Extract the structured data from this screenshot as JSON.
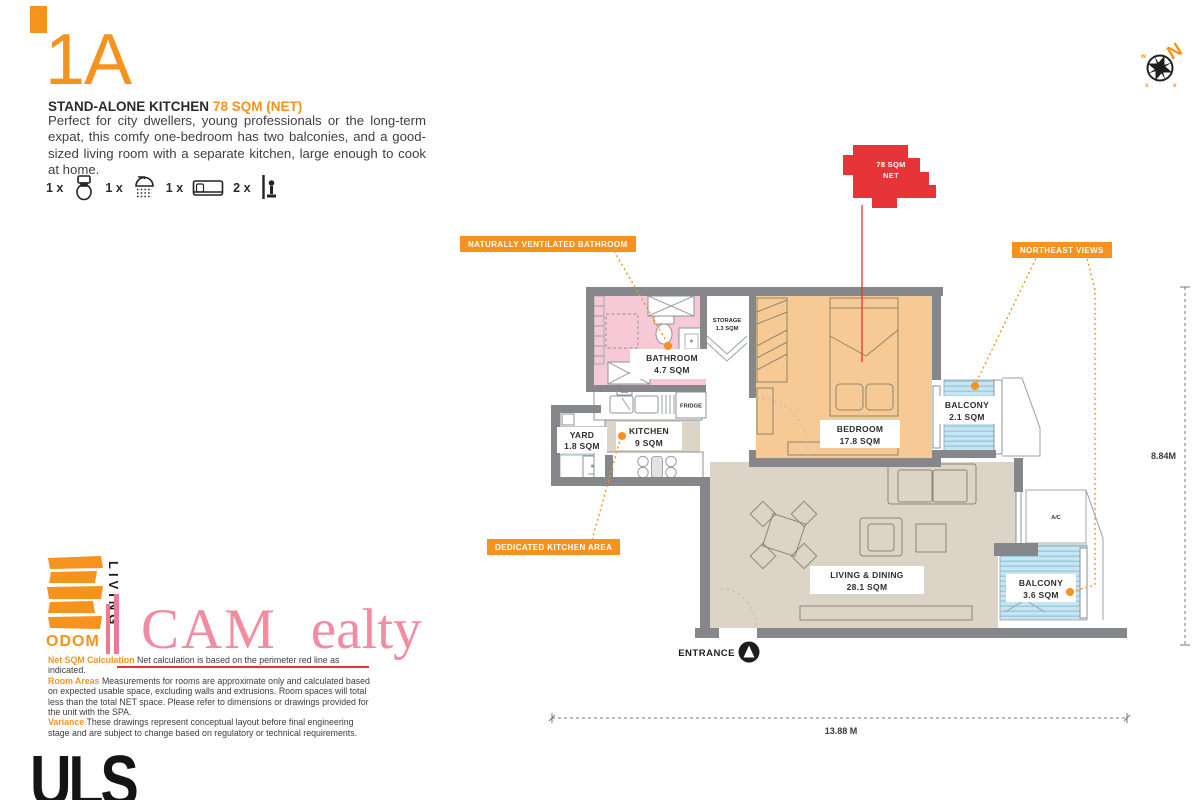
{
  "header": {
    "unit": "1A",
    "subtitle": "STAND-ALONE KITCHEN",
    "area_label": "78 SQM (NET)",
    "description": "Perfect for city dwellers, young professionals or the long-term expat, this comfy one-bedroom has two balconies, and a good-sized living room with a separate kitchen, large enough to cook at home.",
    "features": [
      {
        "qty": "1 x",
        "icon": "toilet-icon"
      },
      {
        "qty": "1 x",
        "icon": "shower-icon"
      },
      {
        "qty": "1 x",
        "icon": "bed-icon"
      },
      {
        "qty": "2 x",
        "icon": "balcony-icon"
      }
    ]
  },
  "compass": {
    "north": "N",
    "west": "w",
    "south": "s",
    "east": "e"
  },
  "plan": {
    "tag": {
      "line1": "78 SQM",
      "line2": "NET"
    },
    "callouts": {
      "bathroom": "NATURALLY VENTILATED BATHROOM",
      "northeast": "NORTHEAST VIEWS",
      "kitchen": "DEDICATED KITCHEN AREA"
    },
    "rooms": {
      "bathroom": {
        "name": "BATHROOM",
        "area": "4.7 SQM"
      },
      "storage": {
        "name": "STORAGE",
        "area": "1.3 SQM"
      },
      "kitchen": {
        "name": "KITCHEN",
        "area": "9 SQM"
      },
      "yard": {
        "name": "YARD",
        "area": "1.8 SQM"
      },
      "bedroom": {
        "name": "BEDROOM",
        "area": "17.8 SQM"
      },
      "balcony1": {
        "name": "BALCONY",
        "area": "2.1 SQM"
      },
      "living": {
        "name": "LIVING & DINING",
        "area": "28.1 SQM"
      },
      "balcony2": {
        "name": "BALCONY",
        "area": "3.6 SQM"
      }
    },
    "fixtures": {
      "fridge": "FRIDGE",
      "ac": "A/C",
      "sink": "S/B"
    },
    "entrance": "ENTRANCE",
    "dimensions": {
      "width": "13.88 M",
      "height": "8.84M"
    }
  },
  "footer": {
    "legal": [
      {
        "label": "Net SQM Calculation",
        "text": " Net calculation is based on the perimeter red line as indicated."
      },
      {
        "label": "Room Areas",
        "text": " Measurements for rooms are approximate only and calculated based on expected usable space, excluding walls and extrusions. Room spaces will total less than the total NET space. Please refer to dimensions or drawings provided for the unit with the SPA."
      },
      {
        "label": "Variance",
        "text": " These drawings represent conceptual layout before final engineering stage and are subject to change based on regulatory or technical requirements."
      }
    ]
  },
  "logos": {
    "odom": "ODOM",
    "living": "LIVING",
    "watermark_1": "CAM",
    "watermark_2": "ealty",
    "uls": "ULS"
  },
  "colors": {
    "accent": "#F6921E",
    "red": "#E63439",
    "bathroom": "#F7C8D5",
    "bedroom": "#F7CA95",
    "living": "#DCD4C7",
    "balcony": "#C6E4F2",
    "balcony_stripe": "#9CCBE0",
    "yard": "#CFE9F6",
    "wall": "#85878A",
    "watermark": "#F18CA1"
  }
}
